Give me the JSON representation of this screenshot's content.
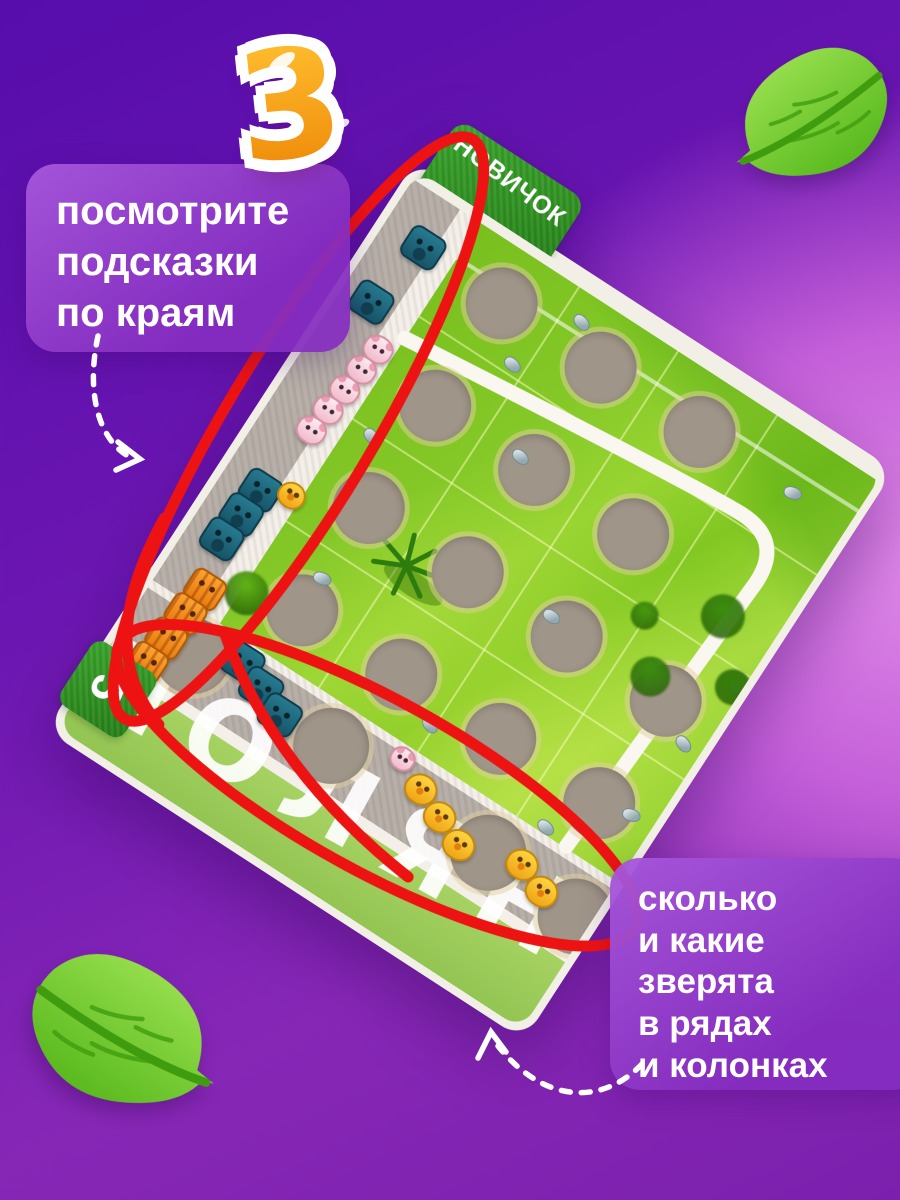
{
  "step_number": "3",
  "callouts": {
    "left": "посмотрите\nподсказки\nпо краям",
    "right": "сколько\nи какие\nзверята\nв рядах\nи колонках"
  },
  "board": {
    "level_tab": "НОВИЧОК",
    "count_tab": "5",
    "logo_text": "ПОЛЯНА",
    "left_edge_hints": [
      {
        "animal": "hippo",
        "count": 1
      },
      {
        "animal": "hippo",
        "count": 1
      },
      {
        "animal": "panda",
        "count": 5
      },
      {
        "animal": "hippo",
        "count": 3
      },
      {
        "animal": "chick",
        "count": 1
      },
      {
        "animal": "tiger",
        "count": 4
      }
    ],
    "bottom_edge_hints": [
      {
        "animal": "hippo",
        "count": 3
      },
      {
        "animal": "panda",
        "count": 1
      },
      {
        "animal": "chick",
        "count": 3
      },
      {
        "animal": "chick",
        "count": 2
      }
    ],
    "field": {
      "rows": 4,
      "cols": 4
    }
  },
  "colors": {
    "background_violet": "#560dab",
    "background_orchid": "#e08ae8",
    "annotation_red": "#ed1313",
    "number_orange": "#f29410",
    "tab_green": "#2f9b22",
    "grass_green": "#8bcd2b",
    "leaf_green": "#5cc21d"
  }
}
